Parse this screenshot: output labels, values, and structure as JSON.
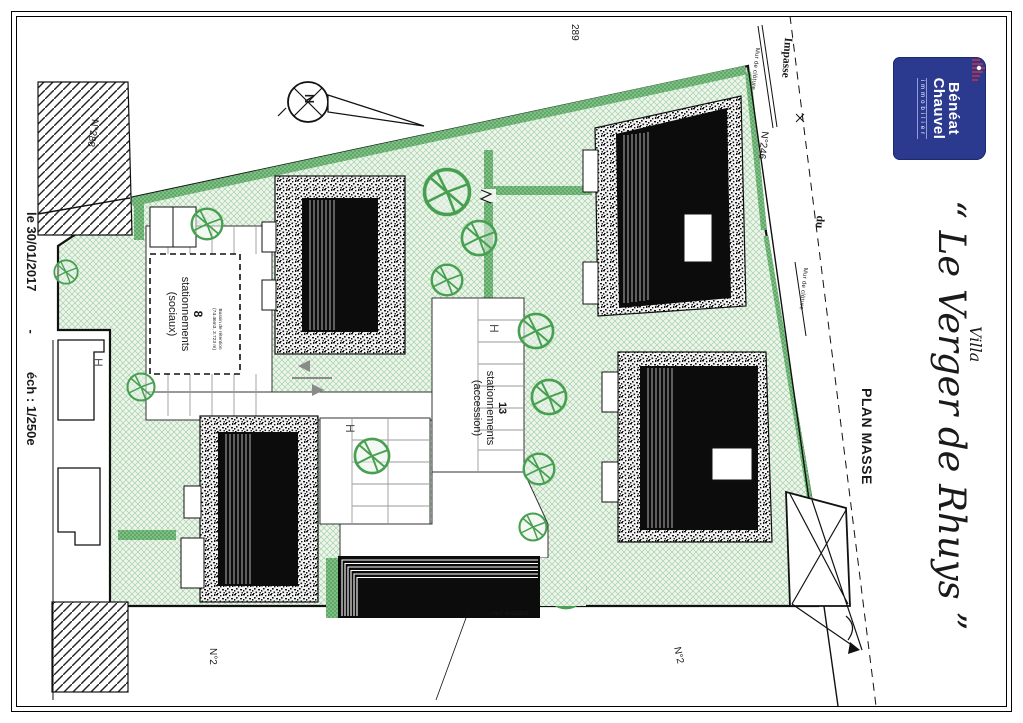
{
  "page": {
    "date": "le 30/01/2017",
    "separator": "-",
    "scale": "éch : 1/250e"
  },
  "title_block": {
    "firm_line1": "Bénéat",
    "firm_line2": "Chauvel",
    "firm_sub": "immobilier",
    "project_prefix": "Villa",
    "project_name": "“ Le Verger de Rhuys ”",
    "drawing_title": "PLAN MASSE",
    "logo_bg": "#2b3a8f",
    "logo_accent": "#c8102e"
  },
  "plan": {
    "north_label": "N",
    "parcel_labels": {
      "top": "289",
      "left": "N°288",
      "right": "N°246",
      "bottom_left": "N°2",
      "bottom_right": "N°2"
    },
    "road": {
      "name_line1": "Impasse",
      "name_line2": "du"
    },
    "walls": {
      "fence_top": "Mur de clôture",
      "fence_mid": "Mur de clôture",
      "existing": "mur existant"
    },
    "parking_social": {
      "count": "8",
      "label": "stationnements",
      "type": "(sociaux)",
      "basin_line1": "Bassin de rétention",
      "basin_line2": "(74.46m3, 3.723 m)"
    },
    "parking_accession": {
      "count": "13",
      "label": "stationnements",
      "type": "(accession)"
    },
    "handicap": "H",
    "colors": {
      "lawn": "#e9f2e9",
      "hedge": "#6fb573",
      "tree": "#46a050",
      "building": "#111111"
    }
  }
}
